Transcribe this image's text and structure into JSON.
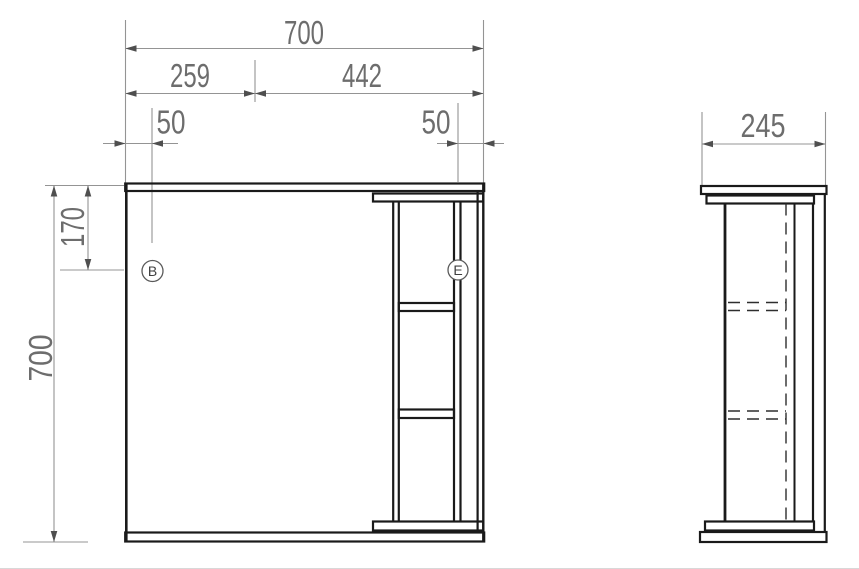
{
  "drawing": {
    "front_view": {
      "width_total": "700",
      "width_left": "259",
      "width_right": "442",
      "offset_left": "50",
      "offset_right": "50",
      "offset_top": "170",
      "height_total": "700",
      "marker_left": "B",
      "marker_right": "E"
    },
    "side_view": {
      "depth": "245"
    },
    "colors": {
      "bold_line": "#1a1a1a",
      "thin_line": "#949494",
      "dimension_text": "#6d6d6d",
      "background": "#ffffff"
    }
  }
}
